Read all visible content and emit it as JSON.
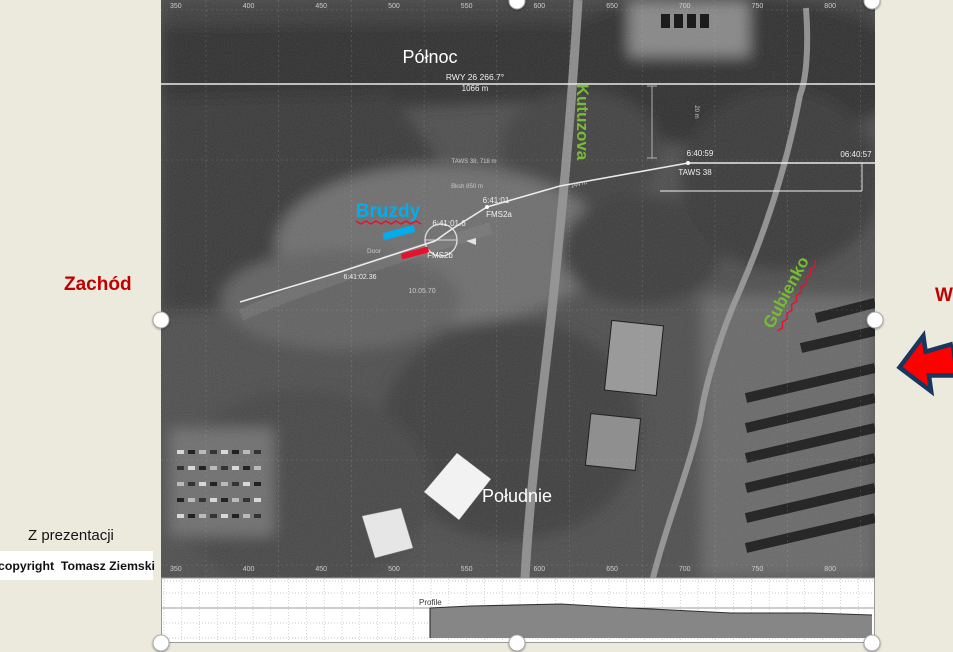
{
  "slide": {
    "background_color": "#ECE9DD",
    "west_label": "Zachód",
    "east_label_partial": "W",
    "source_note": "Z prezentacji",
    "copyright_note": "copyright  Tomasz Ziemski"
  },
  "map": {
    "north_label": "Północ",
    "south_label": "Południe",
    "bruzdy_label": "Bruzdy",
    "street_labels": {
      "kutuzova": "Kutuzova",
      "gubienko": "Gubienko"
    },
    "runway_heading": "RWY 26  266.7°",
    "runway_length": "1066 m",
    "annotations": {
      "taws_alt": "TAWS 38, 718 m",
      "bank_dist": "Bksh 850 m",
      "time_1": "6:40:59",
      "taws_label": "TAWS 38",
      "time_right": "06:40:57",
      "time_2": "6:41:01",
      "fms2a": "FMS2a",
      "time_3": "6:41:01.6",
      "fms2b": "FMS2b",
      "door": "Door",
      "time_4": "6:41:02.36",
      "date_label": "10.05.70",
      "dist_144": "144 m",
      "dist_20": "20 m"
    },
    "ruler_values": [
      350,
      400,
      450,
      500,
      550,
      600,
      650,
      700,
      750,
      800
    ]
  },
  "profile": {
    "label": "Profile",
    "chart_data": {
      "type": "area",
      "x_ruler_values": [
        350,
        400,
        450,
        500,
        550,
        600,
        650,
        700,
        750,
        800
      ],
      "terrain_outline_px": [
        [
          269,
          638
        ],
        [
          269,
          608
        ],
        [
          310,
          606
        ],
        [
          400,
          604
        ],
        [
          450,
          607
        ],
        [
          530,
          611
        ],
        [
          570,
          613
        ],
        [
          650,
          613
        ],
        [
          711,
          615
        ],
        [
          711,
          638
        ]
      ]
    }
  },
  "colors": {
    "slide_background": "#ECE9DD",
    "west_label_red": "#C00000",
    "bruzdy_blue": "#00AEEF",
    "marker_red": "#E8112D",
    "street_green": "#79BB34",
    "arrow_fill": "#FF0000",
    "arrow_border": "#17375E",
    "map_label_white": "#FFFFFF"
  }
}
